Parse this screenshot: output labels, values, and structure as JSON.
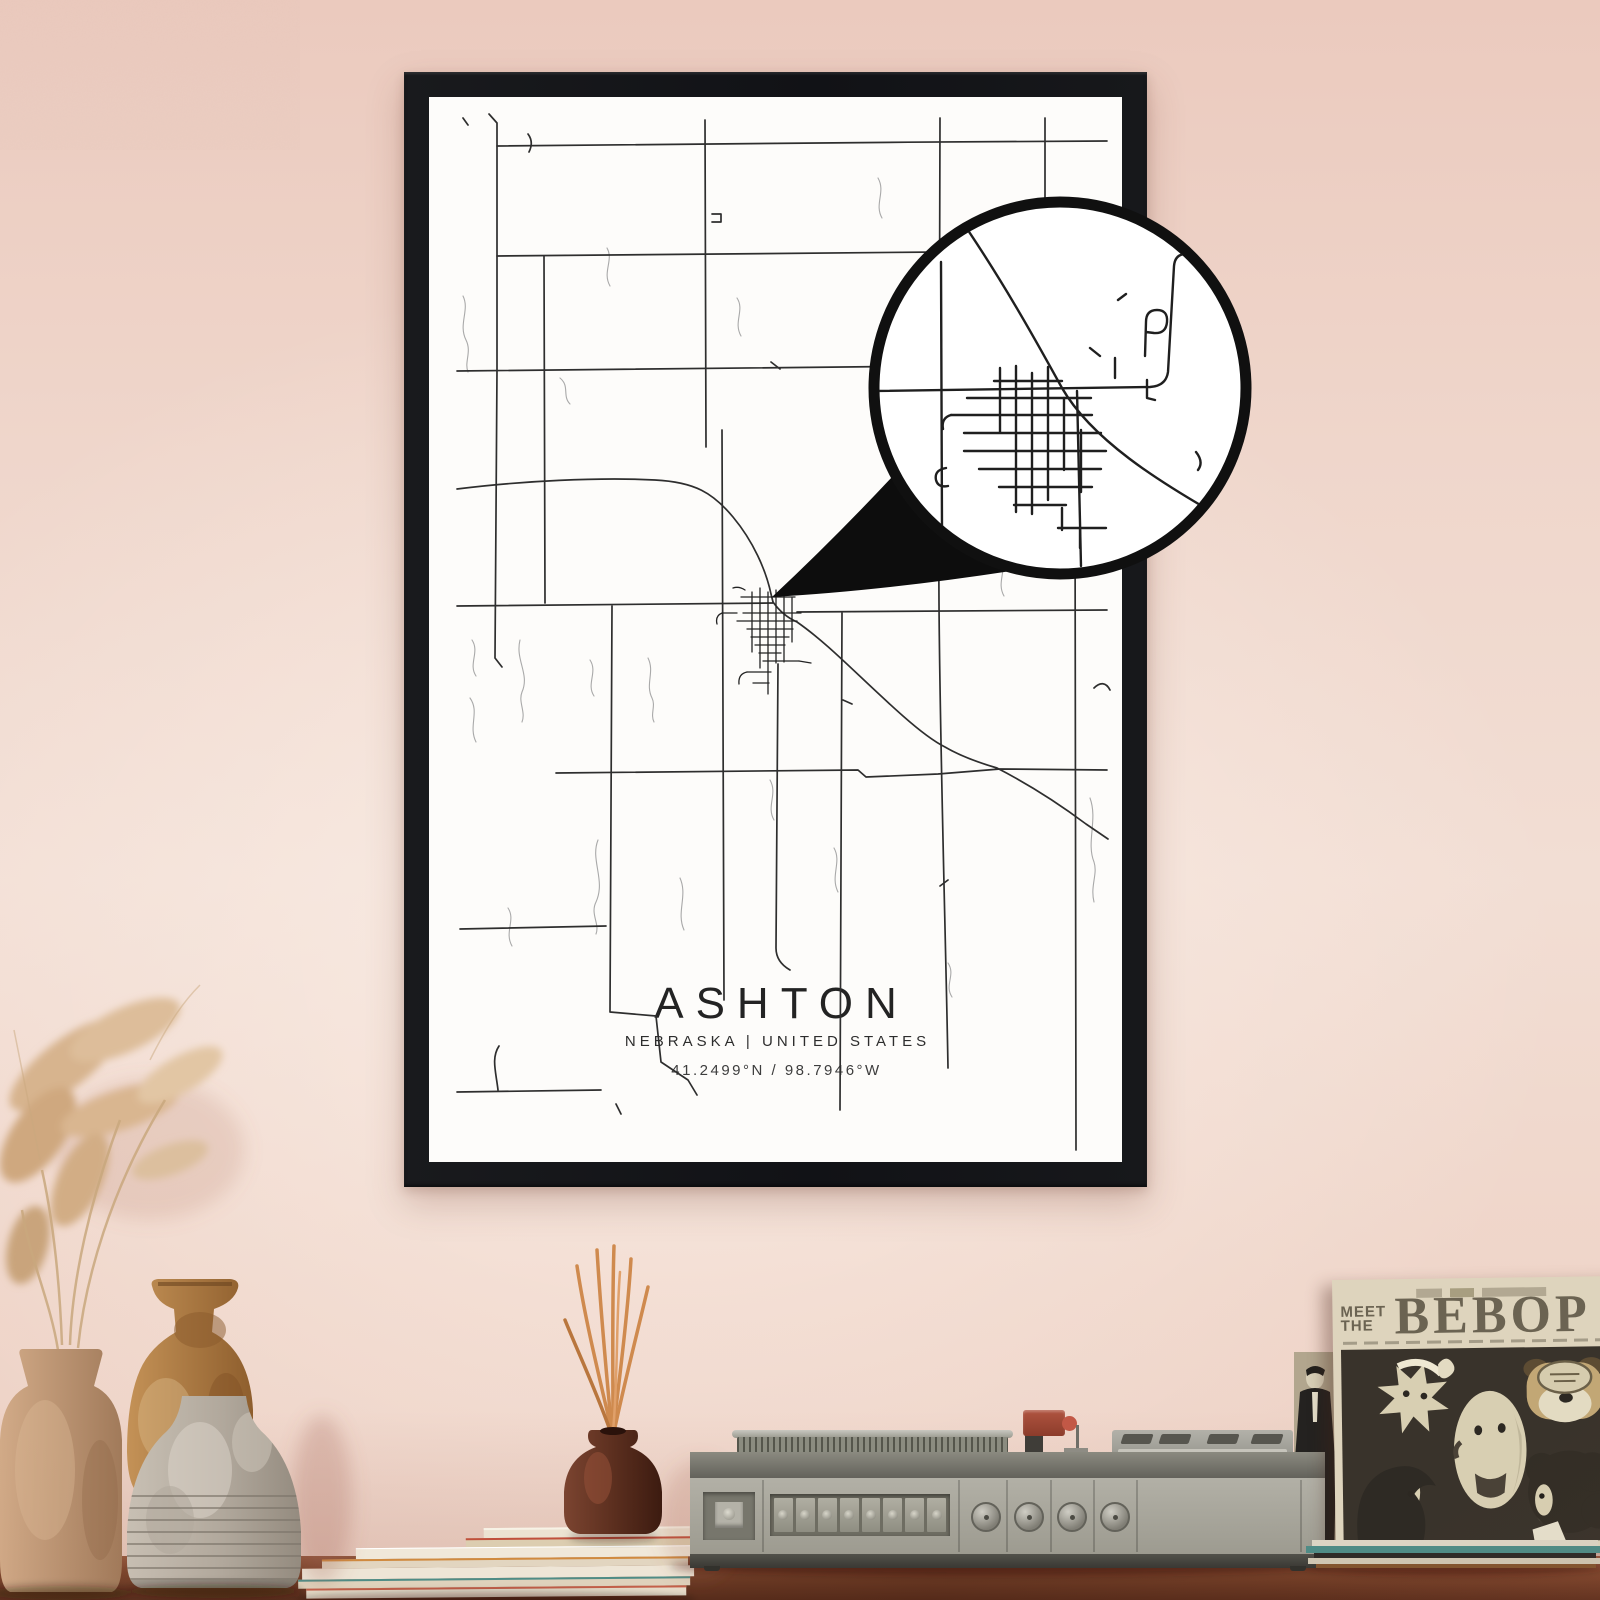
{
  "poster": {
    "title": "ASHTON",
    "region": "NEBRASKA | UNITED STATES",
    "coordinates": "41.2499°N / 98.7946°W",
    "frame_color": "#17181b",
    "paper_color": "#fdfcfa",
    "road_color": "#2e2e2e"
  },
  "magnifier": {
    "ring_color": "#101010",
    "fill_color": "#ffffff"
  },
  "record_sleeve": {
    "pretitle_line1": "MEET",
    "pretitle_line2": "THE",
    "title": "BEBOP",
    "paper_color": "#ded4bd",
    "ink_color": "#6b6352"
  },
  "room": {
    "wall_color": "#efd5c9",
    "shelf_color": "#8a4f33",
    "reed_color": "#cf8a4e",
    "player_body_color": "#9d9b90"
  }
}
